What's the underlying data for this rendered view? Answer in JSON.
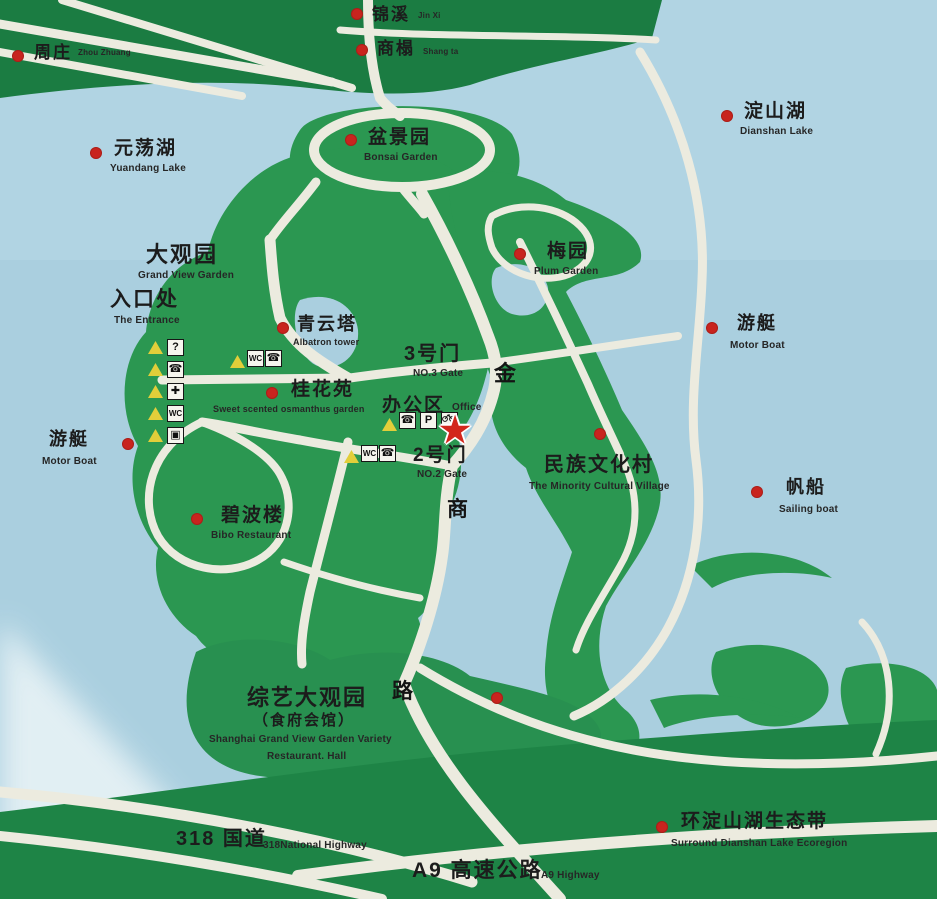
{
  "sign": {
    "type": "park-guide-map",
    "colors": {
      "water": "#aacfdf",
      "land_green": "#2b9751",
      "band_dark_green": "#1b7c42",
      "bottom_band_green": "#1e8446",
      "road_white": "#ecebdf",
      "marker_red": "#c8241e",
      "star_red": "#d2271c",
      "triangle_yellow": "#e2ce3a",
      "text_dark": "#1c1c1c"
    },
    "star_marker": {
      "meaning": "you-are-here",
      "x": 455,
      "y": 432
    },
    "road_name_chars": [
      {
        "char": "金",
        "x": 494,
        "y": 363,
        "s": 22
      },
      {
        "char": "商",
        "x": 447,
        "y": 499,
        "s": 21
      },
      {
        "char": "路",
        "x": 392,
        "y": 681,
        "s": 21
      }
    ],
    "legend_column": {
      "items": [
        {
          "name": "information-icon",
          "glyph": "?",
          "tx": 148,
          "ty": 341,
          "bx": 167,
          "by": 339
        },
        {
          "name": "telephone-icon",
          "glyph": "☎",
          "tx": 148,
          "ty": 363,
          "bx": 167,
          "by": 361
        },
        {
          "name": "first-aid-icon",
          "glyph": "✚",
          "tx": 148,
          "ty": 385,
          "bx": 167,
          "by": 383
        },
        {
          "name": "restroom-icon",
          "glyph": "WC",
          "tx": 148,
          "ty": 407,
          "bx": 167,
          "by": 405
        },
        {
          "name": "shop-icon",
          "glyph": "▣",
          "tx": 148,
          "ty": 429,
          "bx": 167,
          "by": 427
        }
      ]
    },
    "amenity_clusters": [
      {
        "id": "near-qingyun-tower",
        "tx": 230,
        "ty": 355,
        "icons": [
          {
            "name": "restroom-icon",
            "glyph": "WC",
            "x": 247,
            "y": 350
          },
          {
            "name": "telephone-icon",
            "glyph": "☎",
            "x": 265,
            "y": 350
          }
        ]
      },
      {
        "id": "near-office",
        "tx": 382,
        "ty": 418,
        "icons": [
          {
            "name": "telephone-icon",
            "glyph": "☎",
            "x": 399,
            "y": 412
          },
          {
            "name": "parking-icon",
            "glyph": "P",
            "x": 420,
            "y": 412
          },
          {
            "name": "bicycle-icon",
            "glyph": "BIKE",
            "x": 441,
            "y": 412
          }
        ]
      },
      {
        "id": "near-gate2",
        "tx": 344,
        "ty": 450,
        "icons": [
          {
            "name": "restroom-icon",
            "glyph": "WC",
            "x": 361,
            "y": 445
          },
          {
            "name": "telephone-icon",
            "glyph": "☎",
            "x": 379,
            "y": 445
          }
        ]
      }
    ],
    "labels": [
      {
        "id": "zhouzhuang",
        "dot": {
          "x": 18,
          "y": 56
        },
        "zh": {
          "t": "周庄",
          "x": 34,
          "y": 44,
          "s": 17
        },
        "en": {
          "t": "Zhou Zhuang",
          "x": 78,
          "y": 49,
          "s": 8
        }
      },
      {
        "id": "jinxi",
        "dot": {
          "x": 357,
          "y": 14
        },
        "zh": {
          "t": "锦溪",
          "x": 372,
          "y": 6,
          "s": 17
        },
        "en": {
          "t": "Jin Xi",
          "x": 418,
          "y": 12,
          "s": 8
        }
      },
      {
        "id": "shangta",
        "dot": {
          "x": 362,
          "y": 50
        },
        "zh": {
          "t": "商榻",
          "x": 377,
          "y": 40,
          "s": 17
        },
        "en": {
          "t": "Shang ta",
          "x": 423,
          "y": 48,
          "s": 8
        }
      },
      {
        "id": "dianshan-lake",
        "dot": {
          "x": 727,
          "y": 116
        },
        "zh": {
          "t": "淀山湖",
          "x": 744,
          "y": 102,
          "s": 19
        },
        "en": {
          "t": "Dianshan Lake",
          "x": 740,
          "y": 127,
          "s": 10
        }
      },
      {
        "id": "yuandang-lake",
        "dot": {
          "x": 96,
          "y": 153
        },
        "zh": {
          "t": "元荡湖",
          "x": 114,
          "y": 139,
          "s": 19
        },
        "en": {
          "t": "Yuandang Lake",
          "x": 110,
          "y": 164,
          "s": 10
        }
      },
      {
        "id": "bonsai-garden",
        "dot": {
          "x": 351,
          "y": 140
        },
        "zh": {
          "t": "盆景园",
          "x": 368,
          "y": 128,
          "s": 19
        },
        "en": {
          "t": "Bonsai Garden",
          "x": 364,
          "y": 153,
          "s": 10
        }
      },
      {
        "id": "plum-garden",
        "dot": {
          "x": 520,
          "y": 254
        },
        "zh": {
          "t": "梅园",
          "x": 547,
          "y": 242,
          "s": 19
        },
        "en": {
          "t": "Plum Garden",
          "x": 534,
          "y": 267,
          "s": 10
        }
      },
      {
        "id": "grand-view-garden",
        "dot": null,
        "zh": {
          "t": "大观园",
          "x": 146,
          "y": 244,
          "s": 22
        },
        "en": {
          "t": "Grand View Garden",
          "x": 138,
          "y": 271,
          "s": 10
        }
      },
      {
        "id": "the-entrance",
        "dot": null,
        "zh": {
          "t": "入口处",
          "x": 110,
          "y": 289,
          "s": 21
        },
        "en": {
          "t": "The Entrance",
          "x": 114,
          "y": 316,
          "s": 10
        }
      },
      {
        "id": "qingyun-tower",
        "dot": {
          "x": 283,
          "y": 328
        },
        "zh": {
          "t": "青云塔",
          "x": 297,
          "y": 315,
          "s": 18
        },
        "en": {
          "t": "Albatron tower",
          "x": 293,
          "y": 338,
          "s": 9
        }
      },
      {
        "id": "osmanthus-garden",
        "dot": {
          "x": 272,
          "y": 393
        },
        "zh": {
          "t": "桂花苑",
          "x": 291,
          "y": 380,
          "s": 19
        },
        "en": {
          "t": "Sweet scented osmanthus garden",
          "x": 213,
          "y": 405,
          "s": 9
        }
      },
      {
        "id": "no3-gate",
        "dot": null,
        "zh": {
          "t": "3号门",
          "x": 404,
          "y": 344,
          "s": 20
        },
        "en": {
          "t": "NO.3 Gate",
          "x": 413,
          "y": 369,
          "s": 10
        }
      },
      {
        "id": "office",
        "dot": null,
        "zh": {
          "t": "办公区",
          "x": 382,
          "y": 396,
          "s": 19
        },
        "en": {
          "t": "Office",
          "x": 452,
          "y": 403,
          "s": 10
        }
      },
      {
        "id": "no2-gate",
        "dot": null,
        "zh": {
          "t": "2号门",
          "x": 413,
          "y": 446,
          "s": 19
        },
        "en": {
          "t": "NO.2 Gate",
          "x": 417,
          "y": 470,
          "s": 10
        }
      },
      {
        "id": "motor-boat-west",
        "dot": {
          "x": 128,
          "y": 444
        },
        "zh": {
          "t": "游艇",
          "x": 49,
          "y": 430,
          "s": 18
        },
        "en": {
          "t": "Motor Boat",
          "x": 42,
          "y": 457,
          "s": 10
        }
      },
      {
        "id": "motor-boat-east",
        "dot": {
          "x": 712,
          "y": 328
        },
        "zh": {
          "t": "游艇",
          "x": 737,
          "y": 314,
          "s": 18
        },
        "en": {
          "t": "Motor Boat",
          "x": 730,
          "y": 341,
          "s": 10
        }
      },
      {
        "id": "minority-village",
        "dot": {
          "x": 600,
          "y": 434
        },
        "zh": {
          "t": "民族文化村",
          "x": 544,
          "y": 455,
          "s": 20
        },
        "en": {
          "t": "The Minority Cultural Village",
          "x": 529,
          "y": 482,
          "s": 10
        }
      },
      {
        "id": "sailing-boat",
        "dot": {
          "x": 757,
          "y": 492
        },
        "zh": {
          "t": "帆船",
          "x": 786,
          "y": 478,
          "s": 18
        },
        "en": {
          "t": "Sailing boat",
          "x": 779,
          "y": 505,
          "s": 10
        }
      },
      {
        "id": "bibo-restaurant",
        "dot": {
          "x": 197,
          "y": 519
        },
        "zh": {
          "t": "碧波楼",
          "x": 221,
          "y": 506,
          "s": 19
        },
        "en": {
          "t": "Bibo Restaurant",
          "x": 211,
          "y": 531,
          "s": 10
        }
      },
      {
        "id": "variety-hall",
        "dot": {
          "x": 497,
          "y": 698
        },
        "zh": {
          "t": "综艺大观园",
          "x": 247,
          "y": 687,
          "s": 22
        },
        "zh2": {
          "t": "（食府会馆）",
          "x": 253,
          "y": 713,
          "s": 15
        },
        "en": {
          "t": "Shanghai Grand View Garden Variety",
          "x": 209,
          "y": 735,
          "s": 10
        },
        "en2": {
          "t": "Restaurant. Hall",
          "x": 267,
          "y": 752,
          "s": 10
        }
      },
      {
        "id": "ecoregion",
        "dot": {
          "x": 662,
          "y": 827
        },
        "zh": {
          "t": "环淀山湖生态带",
          "x": 681,
          "y": 812,
          "s": 19
        },
        "en": {
          "t": "Surround Dianshan Lake Ecoregion",
          "x": 671,
          "y": 839,
          "s": 10
        }
      },
      {
        "id": "national-highway-318",
        "dot": null,
        "zh": {
          "t": "318 国道",
          "x": 176,
          "y": 829,
          "s": 20
        },
        "en": {
          "t": "318National Highway",
          "x": 263,
          "y": 841,
          "s": 10
        }
      },
      {
        "id": "a9-highway",
        "dot": null,
        "zh": {
          "t": "A9 高速公路",
          "x": 412,
          "y": 860,
          "s": 21
        },
        "en": {
          "t": "A9 Highway",
          "x": 541,
          "y": 871,
          "s": 10
        }
      }
    ]
  }
}
